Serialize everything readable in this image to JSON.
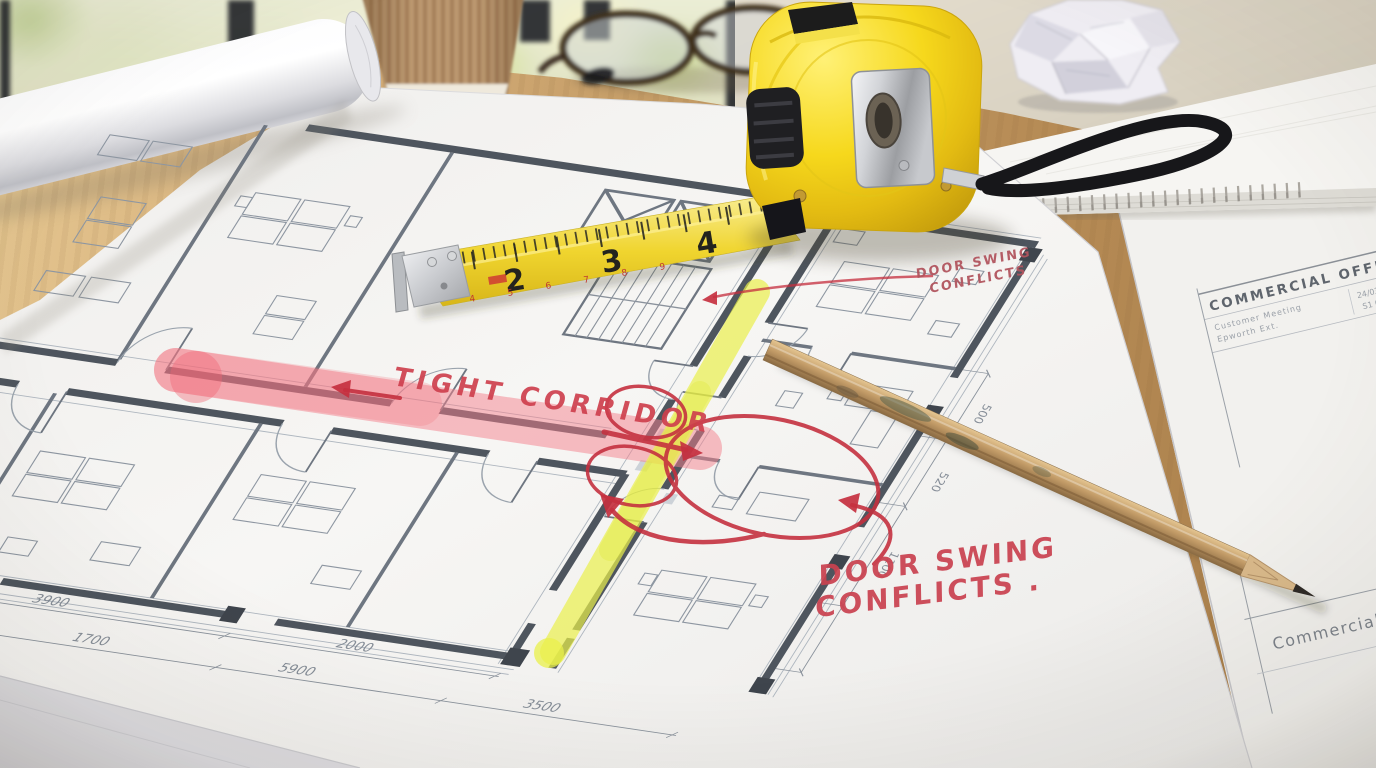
{
  "annotations": {
    "tight_corridor": "TIGHT CORRIDOR",
    "door_swing_top": {
      "line1": "DOOR SWING",
      "line2": "CONFLICTS"
    },
    "door_swing_bottom": {
      "line1": "DOOR SWING",
      "line2": "CONFLICTS ."
    }
  },
  "drawing": {
    "title_block": {
      "title": "COMMERCIAL OFFICE",
      "label1": "Customer Meeting",
      "label2": "Epworth Ext.",
      "value1": "24/03/13",
      "value2": "S1 0213"
    },
    "corner_label": "Commercial",
    "dimensions": {
      "bottom_row1": [
        "3900",
        "2000"
      ],
      "bottom_row2": [
        "1700",
        "5900",
        "3500"
      ],
      "right_column": [
        "500",
        "520",
        "1100"
      ]
    }
  },
  "tape_measure": {
    "big_numbers": [
      "2",
      "3",
      "4"
    ],
    "small_numbers": [
      "4",
      "5",
      "6",
      "7",
      "8",
      "9"
    ]
  },
  "colors": {
    "highlighter_yellow": "#e9f04b",
    "highlighter_pink": "#f3808c",
    "marker_red": "#c5303f",
    "tape_body_yellow": "#f6d81c",
    "pencil_wood": "#c9a06a",
    "desk_wood": "#c79f6c",
    "paper_white": "#f6f5f3",
    "plan_wall": "#4e555e"
  }
}
